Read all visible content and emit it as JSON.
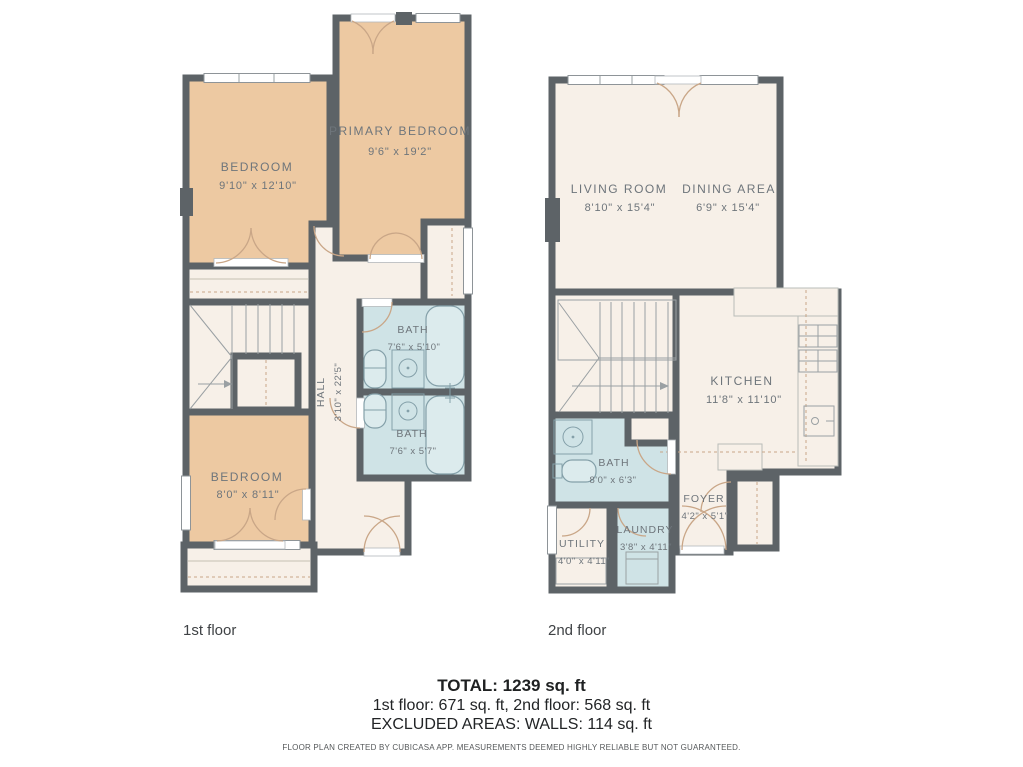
{
  "floor1": {
    "label": "1st floor",
    "rooms": {
      "bedroom_top": {
        "name": "BEDROOM",
        "dims": "9'10\" x 12'10\""
      },
      "primary_bedroom": {
        "name": "PRIMARY BEDROOM",
        "dims": "9'6\" x 19'2\""
      },
      "bath_upper": {
        "name": "BATH",
        "dims": "7'6\" x 5'10\""
      },
      "bath_lower": {
        "name": "BATH",
        "dims": "7'6\" x 5'7\""
      },
      "hall": {
        "name": "HALL",
        "dims": "3'10\" x 22'5\""
      },
      "bedroom_bottom": {
        "name": "BEDROOM",
        "dims": "8'0\" x 8'11\""
      }
    }
  },
  "floor2": {
    "label": "2nd floor",
    "rooms": {
      "living_room": {
        "name": "LIVING ROOM",
        "dims": "8'10\" x 15'4\""
      },
      "dining_area": {
        "name": "DINING AREA",
        "dims": "6'9\" x 15'4\""
      },
      "kitchen": {
        "name": "KITCHEN",
        "dims": "11'8\" x 11'10\""
      },
      "bath": {
        "name": "BATH",
        "dims": "8'0\" x 6'3\""
      },
      "foyer": {
        "name": "FOYER",
        "dims": "4'2\" x 5'1\""
      },
      "utility": {
        "name": "UTILITY",
        "dims": "4'0\" x 4'11\""
      },
      "laundry": {
        "name": "LAUNDRY",
        "dims": "3'8\" x 4'11\""
      }
    }
  },
  "summary": {
    "total": "TOTAL: 1239 sq. ft",
    "floor_breakdown": "1st floor: 671 sq. ft, 2nd floor: 568 sq. ft",
    "excluded": "EXCLUDED AREAS: WALLS: 114 sq. ft"
  },
  "disclaimer": "FLOOR PLAN CREATED BY CUBICASA APP. MEASUREMENTS DEEMED HIGHLY RELIABLE BUT NOT GUARANTEED.",
  "colors": {
    "wall": "#5d6367",
    "bedroom_fill": "#edc9a2",
    "wet_room_fill": "#cfe3e6",
    "floor_fill": "#f7f0e8",
    "label_text": "#6e757b"
  }
}
